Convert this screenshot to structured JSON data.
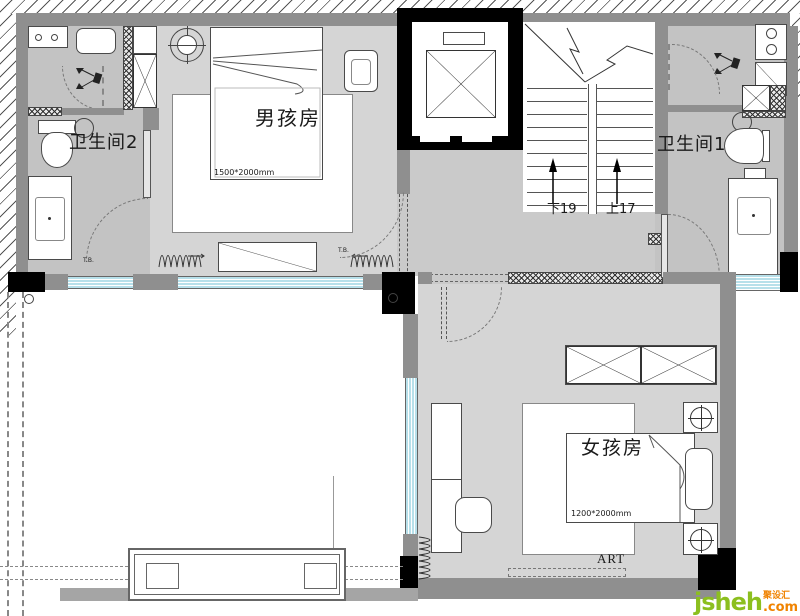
{
  "palette": {
    "wall": "#8f8f8f",
    "column": "#000000",
    "floor_room": "#d5d5d5",
    "floor_bath": "#c3c3c3",
    "floor_corridor": "#cacaca",
    "window": "#b7e0ea",
    "watermark_green": "#8cbf1f",
    "watermark_orange": "#f08300"
  },
  "rooms": {
    "boy_room": {
      "label": "男孩房",
      "bed_size": "1500*2000mm"
    },
    "girl_room": {
      "label": "女孩房",
      "bed_size": "1200*2000mm",
      "mat_label": "ART"
    },
    "bathroom2": {
      "label": "卫生间2"
    },
    "bathroom1": {
      "label": "卫生间1"
    }
  },
  "stairs": {
    "down": "下19",
    "up": "上17"
  },
  "annotations": {
    "tb": "T.B."
  },
  "watermark": {
    "brand": "jsheh",
    "cn": "聚设汇",
    "tld": ".com"
  }
}
